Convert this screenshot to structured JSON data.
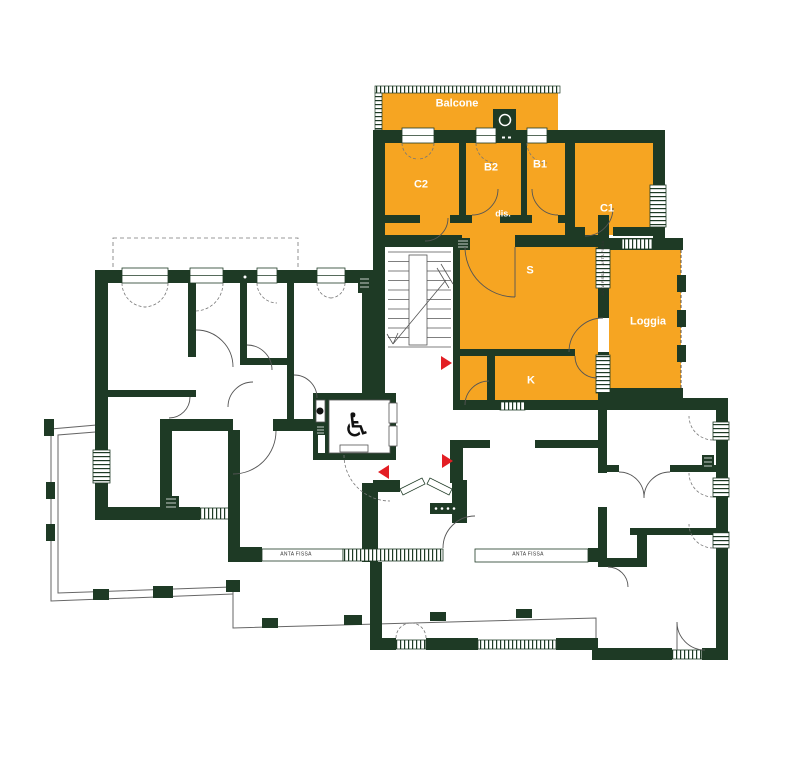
{
  "plan": {
    "type": "apartment floor plan",
    "colors": {
      "highlight": "#F6A522",
      "wall": "#1E3A25",
      "marker": "#E31E24",
      "background": "#FFFFFF"
    },
    "rooms": {
      "balcone": "Balcone",
      "c2": "C2",
      "b2": "B2",
      "b1": "B1",
      "c1": "C1",
      "dis": "dis.",
      "s": "S",
      "k": "K",
      "loggia": "Loggia"
    },
    "annotations": {
      "anta_fissa_left": "ANTA FISSA",
      "anta_fissa_right": "ANTA FISSA",
      "anta_fissa_vertical_1": "ANTA FISSA",
      "anta_fissa_vertical_2": "ANTA FISSA"
    },
    "icons": {
      "wheelchair": "♿"
    }
  }
}
